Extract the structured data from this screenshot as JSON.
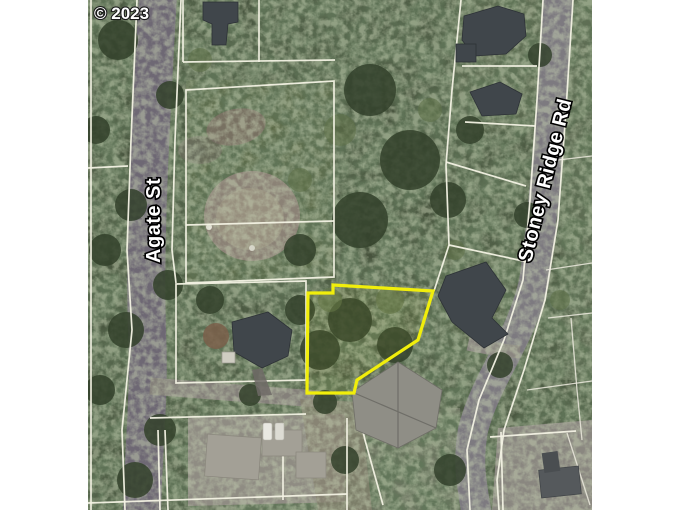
{
  "map": {
    "copyright_label": "© 2023",
    "street_labels": {
      "agate": "Agate St",
      "stoney_ridge": "Stoney Ridge Rd"
    },
    "highlighted_parcel": {
      "outline_color": "#f1ee0b",
      "points": "308,293 333,293 333,285 433,291 418,340 357,380 354,393 307,393"
    },
    "colors": {
      "page_background": "#ffffff",
      "forest_base": "#47533d",
      "road_gray": "#6e6874",
      "road_light": "#7d7a80",
      "driveway": "#8f8c83",
      "parcel_line": "#f3f2e4",
      "dirt_circle": "#8b8276",
      "roof_dark": "#40464b",
      "roof_medium": "#8f8e86",
      "roof_light": "#a3a096"
    }
  }
}
